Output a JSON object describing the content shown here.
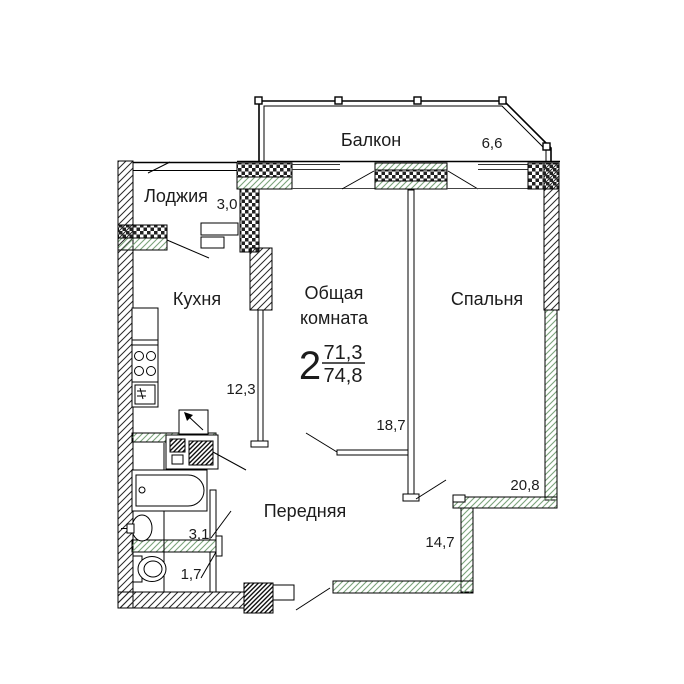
{
  "plan": {
    "type_note": "apartment floor plan",
    "apartment": {
      "rooms_count": "2",
      "living_area": "71,3",
      "total_area": "74,8"
    },
    "rooms": {
      "balcony": {
        "label": "Балкон",
        "area": "6,6"
      },
      "loggia": {
        "label": "Лоджия",
        "area": "3,0"
      },
      "kitchen": {
        "label": "Кухня",
        "area": "12,3"
      },
      "living": {
        "label_line1": "Общая",
        "label_line2": "комната",
        "area": "18,7"
      },
      "bedroom": {
        "label": "Спальня",
        "area": "20,8"
      },
      "hall": {
        "label": "Передняя",
        "area": "14,7"
      },
      "bathroom": {
        "area": "3,1"
      },
      "wc": {
        "area": "1,7"
      }
    },
    "colors": {
      "ink": "#1c1c1c",
      "wall_line": "#000000",
      "hatch_green": "#7aa37a",
      "hatch_black": "#2a2a2a"
    }
  }
}
